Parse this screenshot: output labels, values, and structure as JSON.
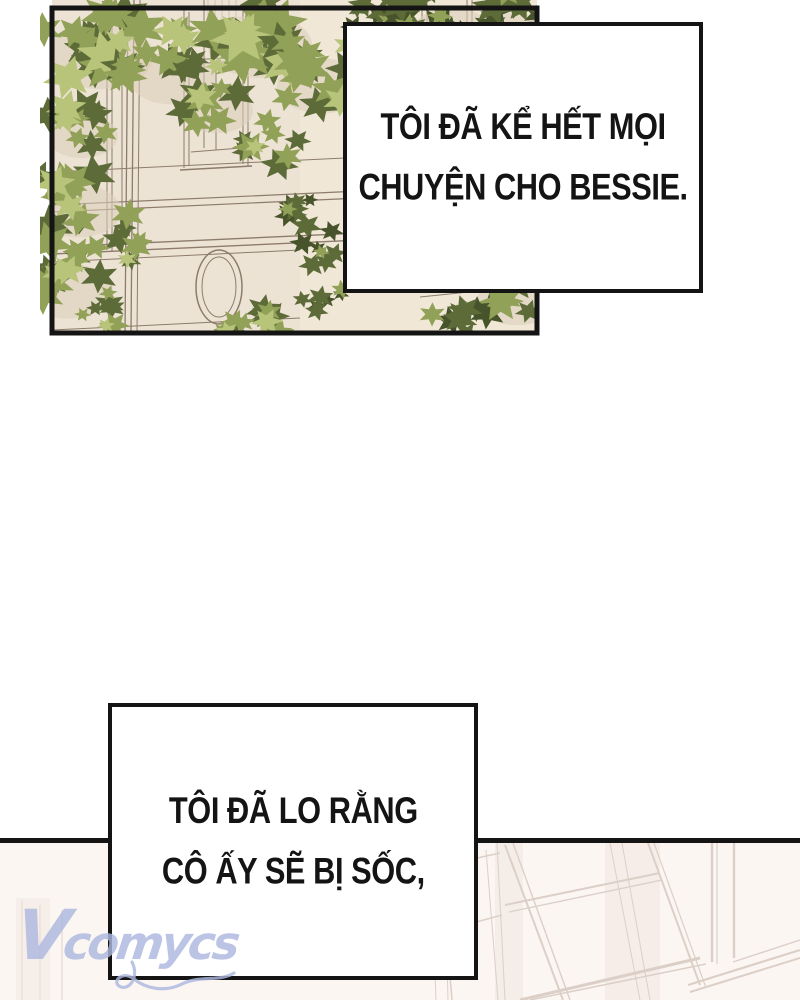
{
  "page": {
    "kind": "webtoon-comic-page"
  },
  "bubbles": {
    "top": {
      "lines": [
        "TÔI ĐÃ KỂ HẾT MỌI",
        "CHUYỆN CHO BESSIE."
      ]
    },
    "bottom": {
      "lines": [
        "TÔI ĐÃ LO RẰNG",
        "CÔ ẤY SẼ BỊ SỐC,"
      ]
    }
  },
  "watermark": {
    "text": "Vcomycs"
  },
  "colors": {
    "ink": "#141414",
    "bubble_bg": "#ffffff",
    "panel_wall": "#ede3d4",
    "panel_wall_light": "#f3eadc",
    "wall_line": "#8c7c6c",
    "wall_shadow": "#dbceba",
    "leaf_light": "#b7c47a",
    "leaf_mid": "#92a158",
    "leaf_dark": "#5c6b38",
    "leaf_deep": "#47542b",
    "faint_bg": "#fbf6f2",
    "faint_line": "#dccfc7",
    "faint_line_soft": "#efe3dd",
    "watermark": "#aeb8e0"
  }
}
